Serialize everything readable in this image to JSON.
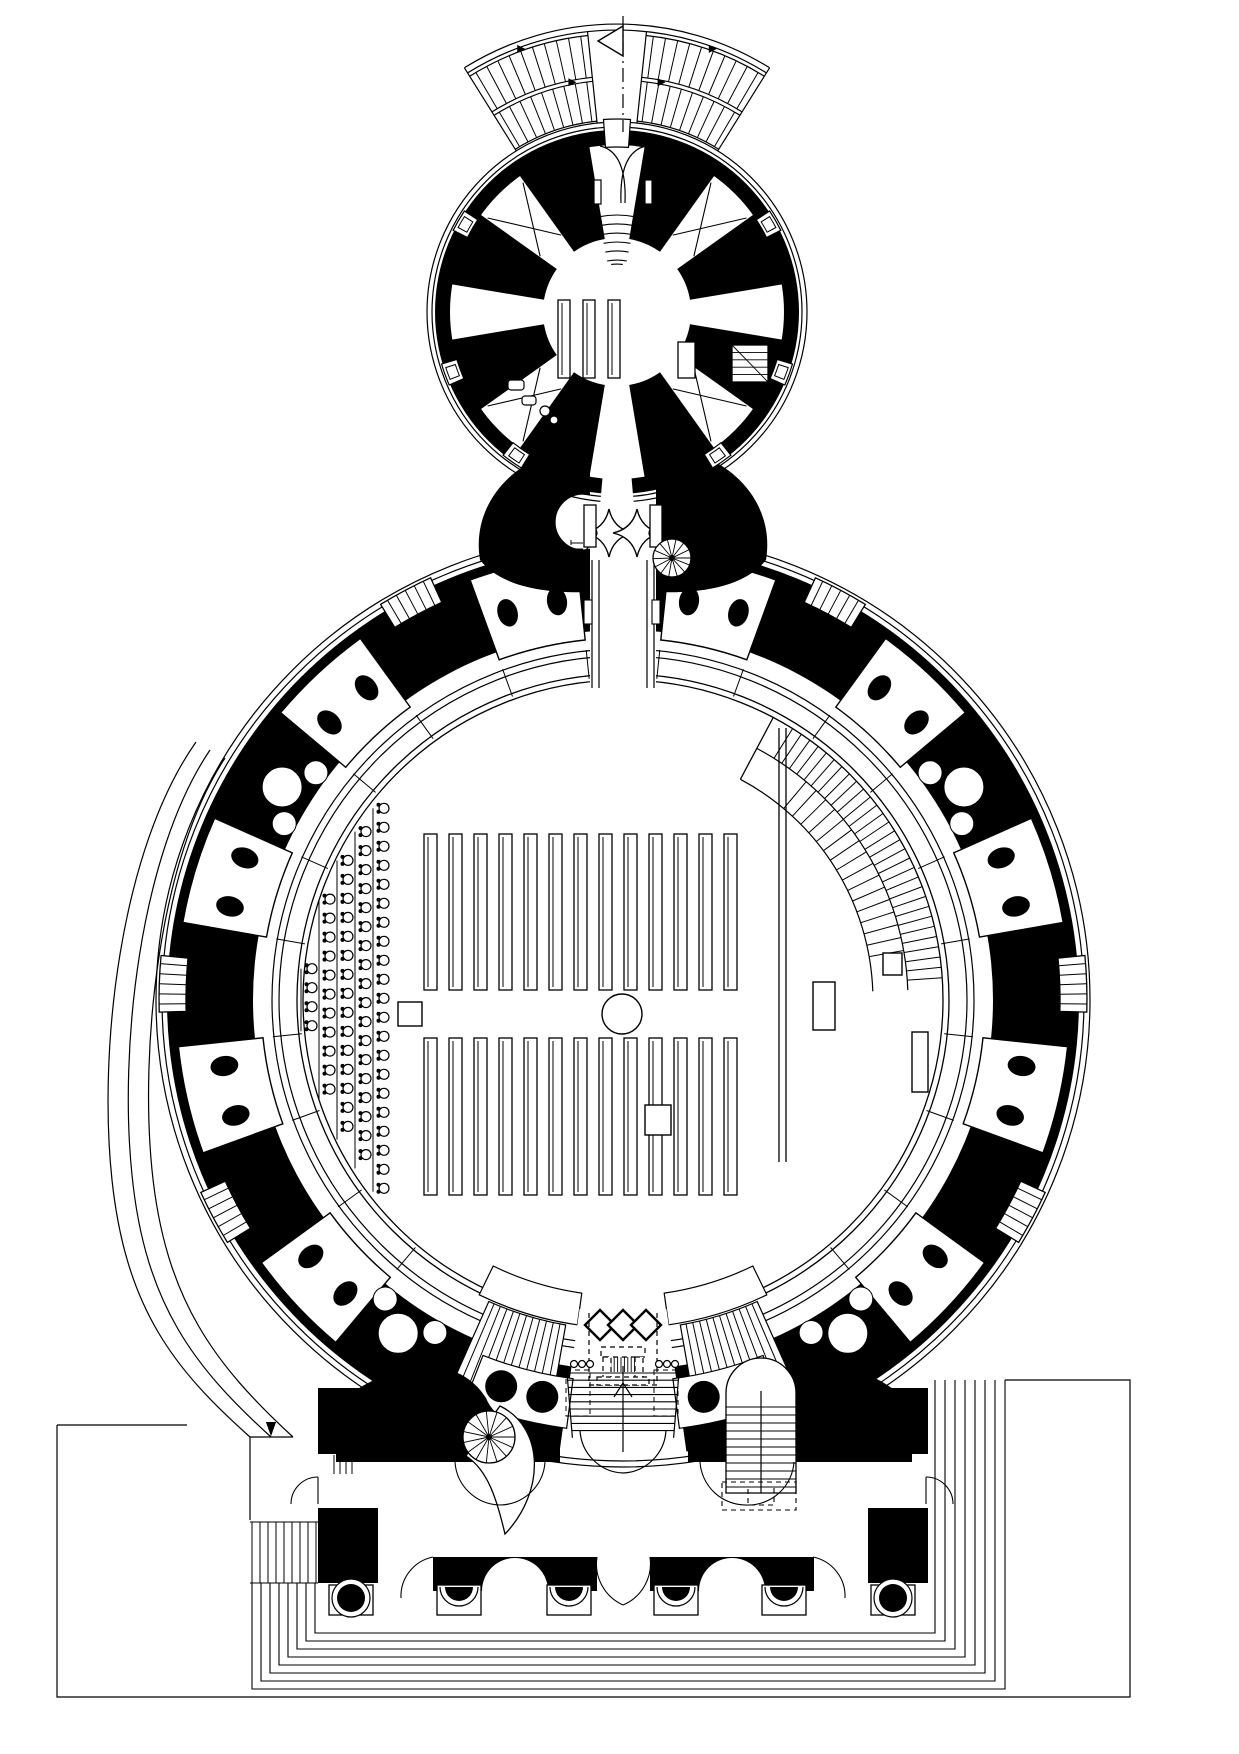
{
  "figure": {
    "kind": "architectural-floor-plan",
    "ink": "#000000",
    "paper": "#ffffff"
  },
  "plan": {
    "canvas": {
      "w": 1239,
      "h": 1754
    },
    "flag": {
      "x": 623,
      "y1": 16,
      "y2": 132,
      "tri": [
        [
          623,
          26
        ],
        [
          623,
          56
        ],
        [
          598,
          41
        ]
      ]
    },
    "annex": {
      "cx": 617,
      "cy": 312,
      "contours": [
        190,
        185
      ],
      "ring": [
        182,
        167
      ],
      "spokes": {
        "angles": [
          22.5,
          67.5,
          112.5,
          157.5,
          202.5,
          247.5,
          292.5,
          337.5
        ],
        "half": 13,
        "r1": 74,
        "r2": 168
      },
      "door": {
        "a1": 86,
        "a2": 94
      },
      "neck_gap": {
        "a1": 265,
        "a2": 275
      },
      "windows": [
        30,
        150,
        200,
        340,
        235,
        305
      ],
      "xbraces": [
        45,
        135,
        225,
        315
      ],
      "fan_in": {
        "radii": [
          52,
          61,
          70,
          79,
          88,
          97
        ],
        "a1": 79,
        "a2": 101
      },
      "tables": {
        "xs": [
          558,
          583,
          608
        ],
        "y": 300,
        "w": 12,
        "h": 78
      },
      "desk": [
        678,
        342,
        17,
        36
      ],
      "winder": [
        732,
        345,
        36,
        37
      ],
      "wc": {
        "rects": [
          [
            508,
            380,
            16,
            10
          ],
          [
            522,
            396,
            14,
            9
          ]
        ],
        "circles": [
          [
            545,
            411,
            5
          ],
          [
            554,
            420,
            4
          ]
        ]
      },
      "stair_out": {
        "platform": [
          282,
          288
        ],
        "a_out": [
          58,
          122
        ],
        "aisle": [
          84,
          96
        ],
        "tiers": [
          {
            "r1": 236,
            "r2": 278,
            "n": 10
          },
          {
            "r1": 192,
            "r2": 232,
            "n": 9
          }
        ]
      }
    },
    "neck": {
      "axis": 623,
      "corridor": {
        "x": 590,
        "y": 440,
        "w": 66,
        "h": 250
      },
      "motif": {
        "stars": [
          [
            609,
            533,
            24
          ],
          [
            637,
            533,
            24
          ]
        ]
      },
      "doors": {
        "left": [
          584,
          505,
          12,
          42
        ],
        "right": [
          650,
          505,
          12,
          42
        ]
      },
      "dashes": {
        "left": [
          560,
          571
        ],
        "right": [
          676,
          684
        ],
        "y1": 540,
        "y2": 576
      },
      "spiral": {
        "cx": 672,
        "cy": 558,
        "r": 19
      },
      "ladder": {
        "x1": 571,
        "x2": 583,
        "y0": 543,
        "dy": 6,
        "n": 5
      }
    },
    "rotunda": {
      "cx": 623,
      "cy": 1000,
      "contours": [
        467,
        461
      ],
      "ring": [
        456,
        370
      ],
      "arcade": [
        351,
        344
      ],
      "hall": [
        326,
        320
      ],
      "pairs": {
        "angles": [
          103,
          77,
          133,
          47,
          163,
          17,
          193,
          347,
          223,
          317
        ],
        "half": 7,
        "r1": 362,
        "r2": 447,
        "er": 404,
        "esep": 3.6,
        "rx": 14,
        "ry": 10
      },
      "windows": {
        "angles": [
          118,
          62,
          178,
          2,
          208,
          332
        ],
        "half": 3.5,
        "r1": 437,
        "r2": 464,
        "n": 5
      },
      "niches": {
        "angles": [
          148,
          32,
          236,
          304
        ],
        "r": 402,
        "big": 20,
        "small": 12,
        "soff": 4.5,
        "sr": 382
      }
    },
    "benches": {
      "x0": 424,
      "pitch": 25,
      "n": 13,
      "w": 13,
      "top": {
        "y": 834,
        "h": 156
      },
      "bot": {
        "y": 1038,
        "h": 157
      }
    },
    "aisle": {
      "square": [
        398,
        1002,
        24
      ],
      "circle": [
        622,
        1014,
        20
      ]
    },
    "chairs": {
      "xs": [
        312,
        330,
        348,
        366,
        384
      ],
      "dy": 19,
      "limit_r": 314,
      "margin": 12
    },
    "ramp": {
      "r_in": 250,
      "r_mid": 285,
      "r_out": 320,
      "a1": 2,
      "a2": 62,
      "ticks_out": {
        "a1": 4,
        "a2": 58,
        "n": 30
      },
      "ticks_in": {
        "a1": 10,
        "a2": 50,
        "n": 16
      },
      "chord": {
        "x1": 779,
        "x2": 786,
        "y1": 728,
        "y2": 1162
      }
    },
    "stage_rects": [
      [
        813,
        982,
        22,
        48
      ],
      [
        883,
        953,
        19,
        22
      ],
      [
        912,
        1032,
        16,
        60
      ],
      [
        645,
        1105,
        26,
        30
      ]
    ],
    "entrance": {
      "bay": {
        "a1": 262,
        "a2": 278,
        "r1": 312,
        "r2": 458
      },
      "landings": {
        "a": [
          [
            244,
            262
          ],
          [
            278,
            296
          ]
        ],
        "r1": 296,
        "r2": 328
      },
      "flights": {
        "a": [
          [
            246,
            260
          ],
          [
            280,
            294
          ]
        ],
        "r1": 330,
        "r2": 420,
        "n": 11
      },
      "panels": {
        "a": [
          [
            248.5,
            262.5
          ],
          [
            277.5,
            291.5
          ]
        ],
        "r1": 382,
        "r2": 432
      },
      "columns": {
        "angles": [
          252.5,
          258.5,
          281.5,
          287.5
        ],
        "r": 405,
        "size": 16
      },
      "diamonds": {
        "cxs": [
          600,
          623,
          646
        ],
        "cy": 1325,
        "hd": 15
      },
      "dash_box": {
        "x1": 589,
        "x2": 657,
        "y1": 1313,
        "y2": 1385
      },
      "console": {
        "x": 601,
        "y": 1347,
        "w": 44
      },
      "beads": {
        "left_x": 574,
        "right_x": 659,
        "y": 1364,
        "n": 3,
        "dx": 8,
        "r": 3.5
      },
      "bead_boxes": [
        [
          566,
          1370,
          24,
          46
        ],
        [
          654,
          1370,
          24,
          46
        ]
      ],
      "stair": {
        "x1": 567,
        "x2": 679,
        "y0": 1373,
        "dy": 7.2,
        "n": 9,
        "cx": 623,
        "cy1": 1366,
        "cy2": 1452
      }
    },
    "vestibule": {
      "spiral": {
        "cx": 489,
        "cy": 1437,
        "r": 26
      },
      "ustair": {
        "x": 726,
        "y": 1393,
        "w": 70,
        "h": 100,
        "r": 35,
        "dy": 8
      },
      "dash_rects": [
        [
          722,
          1482,
          74,
          28
        ],
        [
          748,
          1487,
          26,
          18
        ]
      ],
      "door": {
        "x1": 580,
        "x2": 666,
        "y": 1430,
        "apex": [
          623,
          1473
        ]
      },
      "piers": [
        [
          318,
          1388,
          60,
          66
        ],
        [
          318,
          1508,
          60,
          75
        ],
        [
          868,
          1388,
          60,
          66
        ],
        [
          868,
          1508,
          60,
          75
        ]
      ],
      "corr_lines_left": {
        "xs": [
          334,
          340,
          346,
          352
        ],
        "y1": 1455,
        "y2": 1474
      },
      "corr_lines_right": {
        "xs": [
          827,
          835,
          843,
          851
        ],
        "y1": 1392,
        "y2": 1462
      },
      "door_arcs": [
        [
          318,
          1477,
          27,
          "left"
        ],
        [
          926,
          1477,
          27,
          "right"
        ]
      ]
    },
    "portico": {
      "lintels": [
        [
          433,
          1557,
          164,
          34
        ],
        [
          650,
          1557,
          164,
          34
        ]
      ],
      "arch_r": 33,
      "bases": {
        "cxs": [
          351,
          459,
          569,
          676,
          784,
          893
        ],
        "cy": 1600,
        "w": 44,
        "h": 30,
        "corner": [
          0,
          5
        ]
      },
      "scallops": {
        "pair_mid": 623,
        "pair_y": 1605,
        "from": [
          597,
          650
        ],
        "top_y": 1557
      }
    },
    "steps": {
      "n": 8,
      "y0": 1633,
      "dy": 8,
      "left_x0": 315,
      "left_dx": -9,
      "left_top": 1583,
      "right_x0": 935,
      "right_dx": 10,
      "right_top": 1380,
      "hatch": {
        "x0": 252,
        "dx": 8,
        "n": 9,
        "y1": 1522,
        "y2": 1583
      },
      "bounds": {
        "wx": 57,
        "wy": 1425,
        "wx2": 187,
        "by": 1697,
        "ex": 1130,
        "ey": 1380,
        "ex2": 1005
      }
    },
    "west_ramp": {
      "curves": [
        "M196,742 C120,850 98,1050 112,1180 C126,1310 175,1370 250,1437",
        "M210,750 C139,855 119,1050 132,1175 C145,1305 195,1368 271,1437",
        "M225,758 C158,860 140,1050 152,1170 C165,1300 215,1365 293,1437"
      ],
      "arrow": [
        [
          266,
          1422
        ],
        [
          276,
          1422
        ],
        [
          271,
          1436
        ]
      ],
      "landing": [
        250,
        1437,
        293,
        1437
      ],
      "room_wall": [
        250,
        1437,
        250,
        1520
      ]
    }
  }
}
